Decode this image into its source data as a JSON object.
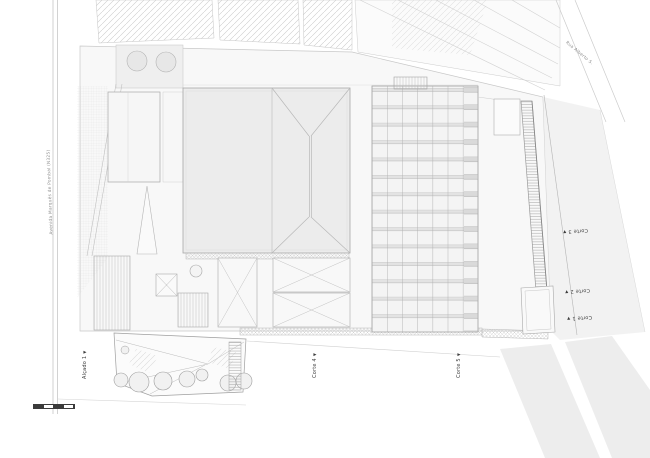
{
  "drawing": {
    "type": "architectural-site-plan",
    "streets": {
      "left": {
        "label": "Avenida Marquês de Pombal (N325)"
      },
      "top_right": {
        "label": "Rua Alberto S."
      }
    },
    "section_markers": {
      "marker_glyph": "▼",
      "right": [
        {
          "label": "Corte 3"
        },
        {
          "label": "Corte 2"
        },
        {
          "label": "Corte 1"
        }
      ],
      "bottom": [
        {
          "label": "Corte 4"
        },
        {
          "label": "Corte 5"
        }
      ],
      "elevation": {
        "label": "Alçado 1"
      }
    },
    "scale_bar": {
      "segments": 4
    },
    "colors": {
      "paper": "#ffffff",
      "site_fill": "#f7f7f7",
      "building_fill": "#ececec",
      "line_light": "#c9c9c9",
      "line_mid": "#a8a8a8",
      "marker_text": "#3d3d3d"
    }
  }
}
